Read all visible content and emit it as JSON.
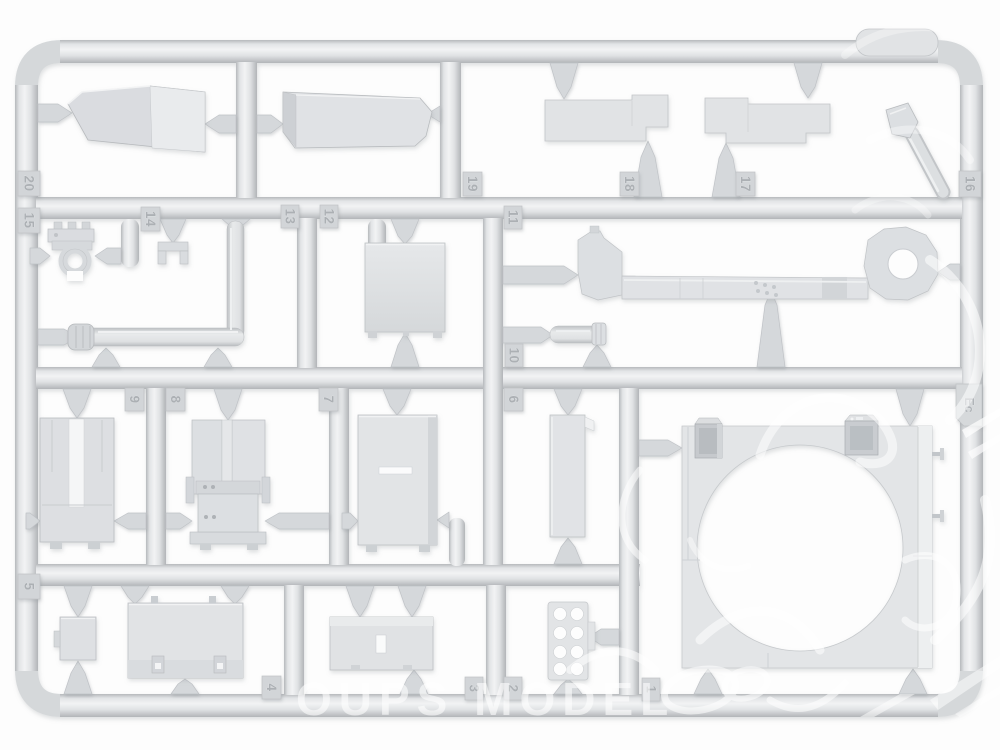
{
  "scene": {
    "description": "Photo of a light-gray injection-molded plastic model-kit sprue (parts tree) on a white background",
    "background_color": "#fdfdfd"
  },
  "sprue": {
    "plastic_color": "#d9dbdd",
    "plastic_dark": "#b4b7ba",
    "plastic_light": "#f1f2f3",
    "id": "Ec",
    "tags": {
      "n1": "1",
      "n2": "2",
      "n3": "3",
      "n4": "4",
      "n5": "5",
      "n6": "6",
      "n7": "7",
      "n8": "8",
      "n9": "9",
      "n10": "10",
      "n11": "11",
      "n12": "12",
      "n13": "13",
      "n14": "14",
      "n15": "15",
      "n16": "16",
      "n17": "17",
      "n18": "18",
      "n19": "19",
      "n20": "20",
      "id": "Ec"
    },
    "parts": {
      "1": "large square panel with big circular opening and two corner clips",
      "2": "small plate with eight holes",
      "3": "low rectangular box lid with slot",
      "4": "large stowage box with latches",
      "5": "small box with side tab",
      "6": "narrow vertical strip panel",
      "7": "tall rectangular box with slot",
      "8": "box with hinged twin panels",
      "9": "box with central vertical slot",
      "10": "short cylinder with ringed tip",
      "11": "long bracket arm with round eye end",
      "12": "square panel with feet",
      "13": "L-shaped exhaust pipe with muffler tip",
      "14": "small U-channel bracket",
      "15": "pipe clamp bracket",
      "16": "angled rod with nozzle head",
      "17": "flat notched hull plate",
      "18": "flat notched hull plate",
      "19": "long tapered wedge box",
      "20": "long tapered wedge box"
    }
  },
  "watermark": {
    "text": "OUPS MODEL",
    "color": "#ffffff"
  }
}
